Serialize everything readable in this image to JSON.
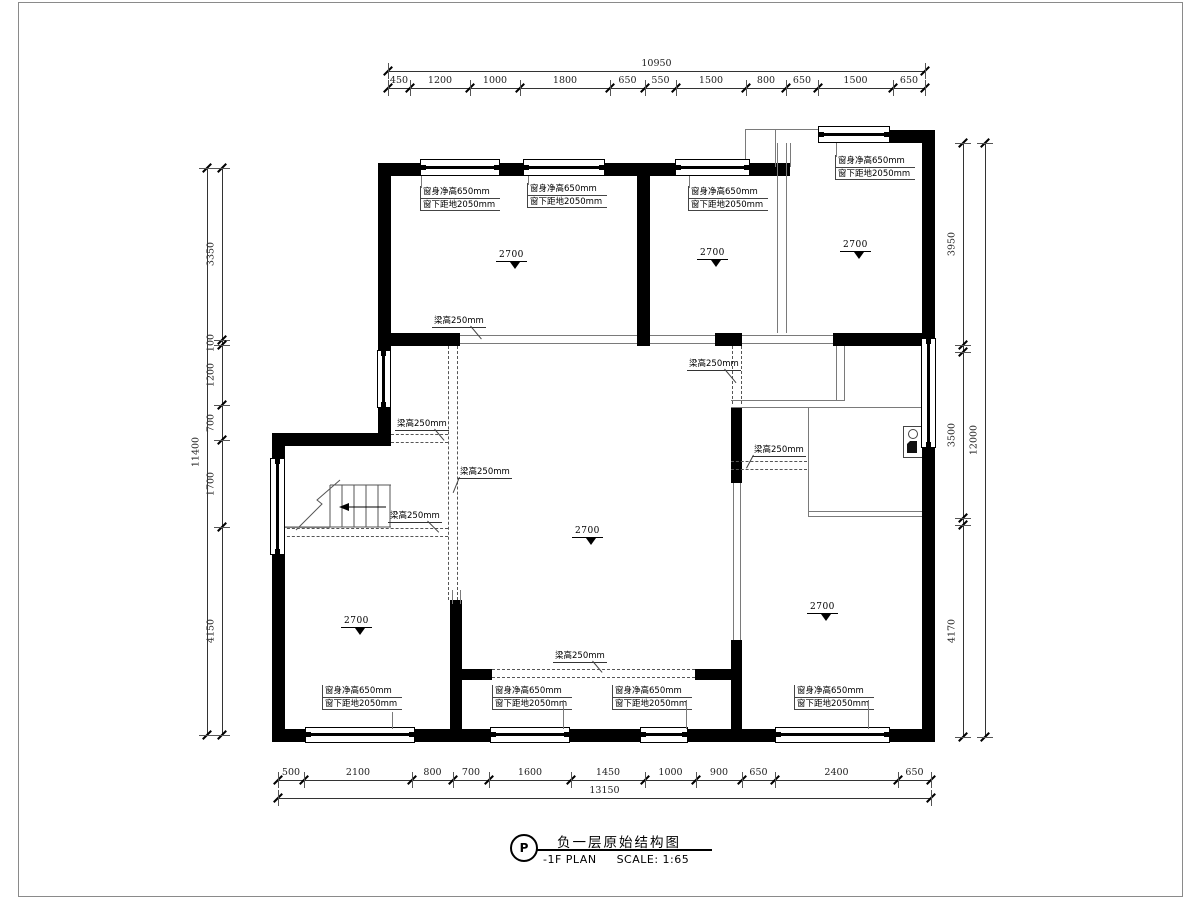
{
  "title_block": {
    "bubble": "P",
    "title": "负一层原始结构图",
    "subtitle": "-1F PLAN",
    "scale": "SCALE: 1:65"
  },
  "labels": {
    "window_line1": "窗身净高650mm",
    "window_line2": "窗下距地2050mm",
    "beam": "梁高250mm",
    "level": "2700"
  },
  "dimensions": {
    "top": {
      "total": "10950",
      "segments": [
        "450",
        "1200",
        "1000",
        "1800",
        "650",
        "550",
        "1500",
        "800",
        "650",
        "1500",
        "650"
      ]
    },
    "bottom": {
      "total": "13150",
      "segments": [
        "500",
        "2100",
        "800",
        "700",
        "1600",
        "1450",
        "1000",
        "900",
        "650",
        "2400",
        "650"
      ]
    },
    "left": {
      "total": "11400",
      "segments": [
        "3350",
        "100",
        "1200",
        "700",
        "1700",
        "4150"
      ]
    },
    "right": {
      "total": "12000",
      "segments": [
        "3950",
        "3500",
        "4170"
      ]
    }
  }
}
